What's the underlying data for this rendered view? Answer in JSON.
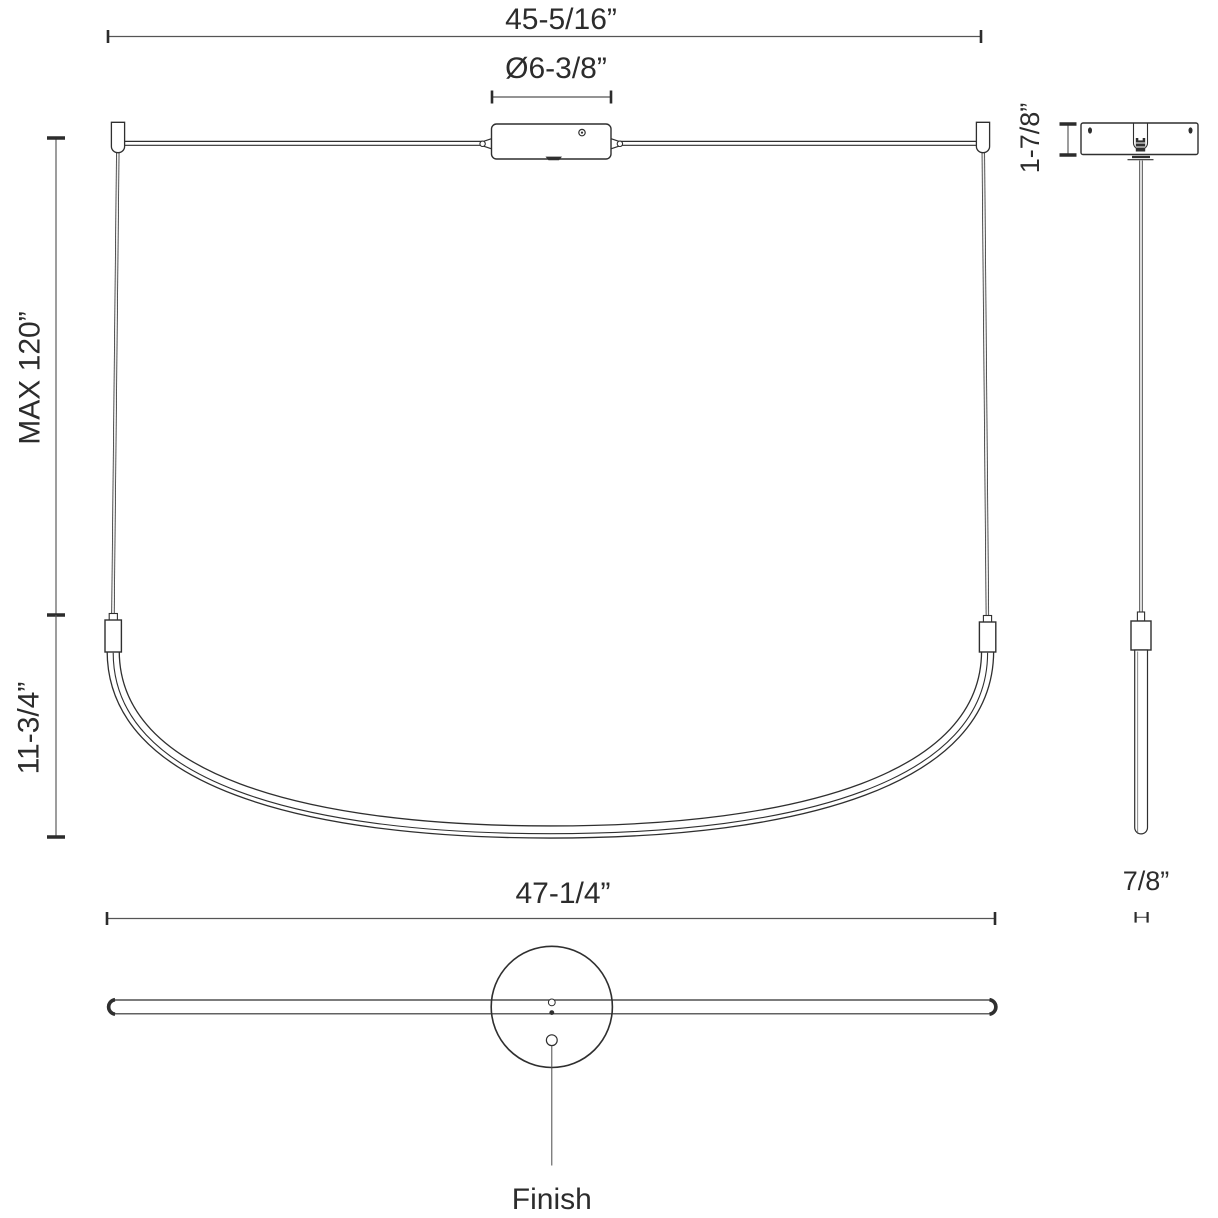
{
  "colors": {
    "background": "#ffffff",
    "object_line": "#2f2f2f",
    "dimension_line": "#555555",
    "text": "#2c2c2c"
  },
  "dims": {
    "overall_width": "45-5/16”",
    "canopy_diameter": "Ø6-3/8”",
    "canopy_height": "1-7/8”",
    "max_suspension": "MAX 120”",
    "fixture_drop": "11-3/4”",
    "overall_length": "47-1/4”",
    "tube_diameter": "7/8”",
    "finish": "Finish"
  }
}
